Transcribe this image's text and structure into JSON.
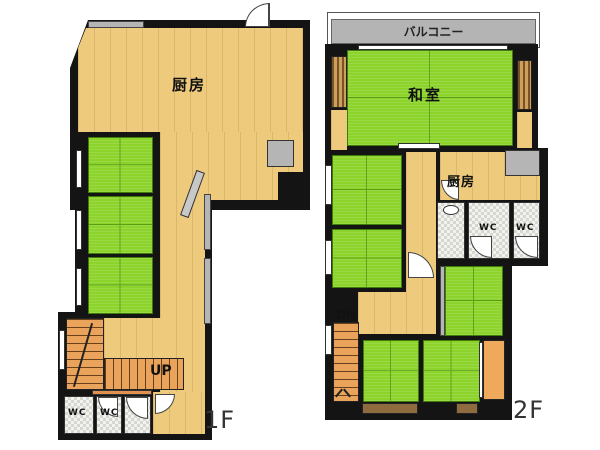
{
  "floor1": {
    "label": "1F",
    "kitchen_label": "厨房",
    "up_label": "UP",
    "wc1_label": "WC",
    "wc2_label": "WC"
  },
  "floor2": {
    "label": "2F",
    "balcony_label": "バルコニー",
    "washitsu_label": "和室",
    "kitchen_label": "厨房",
    "wc1_label": "WC",
    "wc2_label": "WC",
    "dn_label": "DN"
  },
  "colors": {
    "wall": "#141414",
    "wood_floor": "#edca7c",
    "tatami_green": "#8cd32c",
    "tatami_line": "#57a00e",
    "stairs_orange": "#eaa35b",
    "tile_gray": "#f2f2ef",
    "balcony_gray": "#b4b4b4",
    "closet_brown": "#8f6c3f",
    "window_gray": "#b5b5b5"
  }
}
